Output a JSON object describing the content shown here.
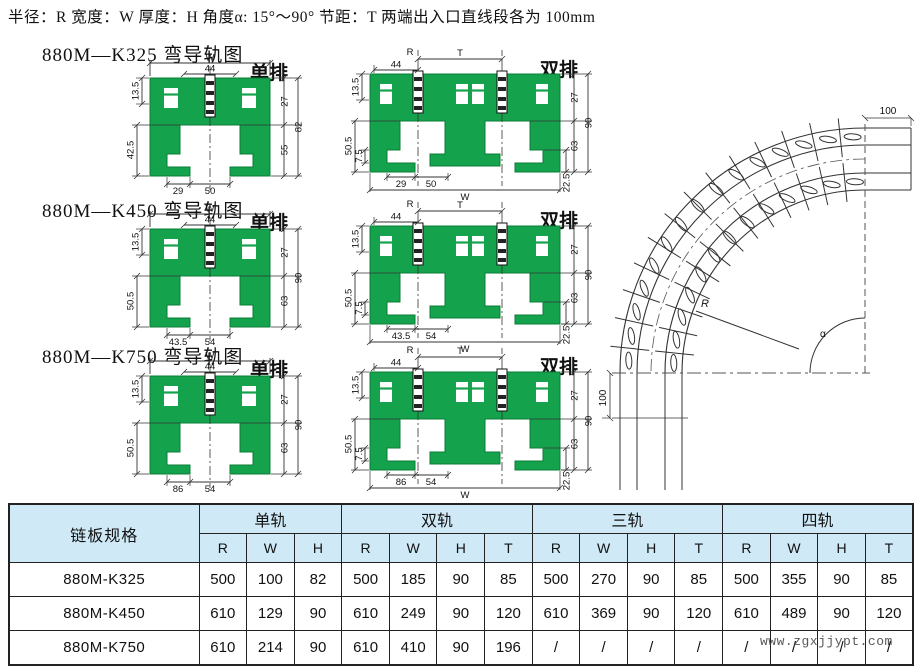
{
  "header": {
    "text": "半径：R  宽度：W  厚度：H  角度α: 15°～90°  节距：T  两端出入口直线段各为 100mm"
  },
  "colors": {
    "green": "#14a24c",
    "green_dark": "#0a7c36",
    "table_header_bg": "#cfe9f6",
    "line": "#333333"
  },
  "sections": [
    {
      "title": "880M—K325 弯导轨图",
      "single_label": "单排",
      "double_label": "双排",
      "single": {
        "w": "W",
        "d44": "44",
        "l1": "13.5",
        "l2": "42.5",
        "b1": "29",
        "b2": "50",
        "r1": "27",
        "r2": "55",
        "r3": "82"
      },
      "double": {
        "r": "R",
        "t": "T",
        "d44": "44",
        "l1": "13.5",
        "l2": "50.5",
        "l3": "7.5",
        "b1": "29",
        "b2": "50",
        "w": "W",
        "br": "22.5",
        "r1": "27",
        "r2": "63",
        "r3": "90"
      }
    },
    {
      "title": "880M—K450 弯导轨图",
      "single_label": "单排",
      "double_label": "双排",
      "single": {
        "w": "W",
        "d44": "44",
        "l1": "13.5",
        "l2": "50.5",
        "b1": "43.5",
        "b2": "54",
        "r1": "27",
        "r2": "63",
        "r3": "90"
      },
      "double": {
        "r": "R",
        "t": "T",
        "d44": "44",
        "l1": "13.5",
        "l2": "50.5",
        "l3": "7.5",
        "b1": "43.5",
        "b2": "54",
        "w": "W",
        "br": "22.5",
        "r1": "27",
        "r2": "63",
        "r3": "90"
      }
    },
    {
      "title": "880M—K750 弯导轨图",
      "single_label": "单排",
      "double_label": "双排",
      "single": {
        "w": "W",
        "d44": "44",
        "l1": "13.5",
        "l2": "50.5",
        "b1": "86",
        "b2": "54",
        "r1": "27",
        "r2": "63",
        "r3": "90"
      },
      "double": {
        "r": "R",
        "t": "T",
        "d44": "44",
        "l1": "13.5",
        "l2": "50.5",
        "l3": "7.5",
        "b1": "86",
        "b2": "54",
        "w": "W",
        "br": "22.5",
        "r1": "27",
        "r2": "63",
        "r3": "90"
      }
    }
  ],
  "curve": {
    "top_dim": "100",
    "bottom_dim": "100",
    "radius_label": "R",
    "angle_label": "α"
  },
  "table": {
    "col1": "链板规格",
    "groups": [
      {
        "label": "单轨",
        "cols": [
          "R",
          "W",
          "H"
        ]
      },
      {
        "label": "双轨",
        "cols": [
          "R",
          "W",
          "H",
          "T"
        ]
      },
      {
        "label": "三轨",
        "cols": [
          "R",
          "W",
          "H",
          "T"
        ]
      },
      {
        "label": "四轨",
        "cols": [
          "R",
          "W",
          "H",
          "T"
        ]
      }
    ],
    "rows": [
      {
        "name": "880M-K325",
        "cells": [
          "500",
          "100",
          "82",
          "500",
          "185",
          "90",
          "85",
          "500",
          "270",
          "90",
          "85",
          "500",
          "355",
          "90",
          "85"
        ]
      },
      {
        "name": "880M-K450",
        "cells": [
          "610",
          "129",
          "90",
          "610",
          "249",
          "90",
          "120",
          "610",
          "369",
          "90",
          "120",
          "610",
          "489",
          "90",
          "120"
        ]
      },
      {
        "name": "880M-K750",
        "cells": [
          "610",
          "214",
          "90",
          "610",
          "410",
          "90",
          "196",
          "/",
          "/",
          "/",
          "/",
          "/",
          "/",
          "/",
          "/"
        ]
      }
    ],
    "watermark": "www.zgxjjypt.com"
  }
}
